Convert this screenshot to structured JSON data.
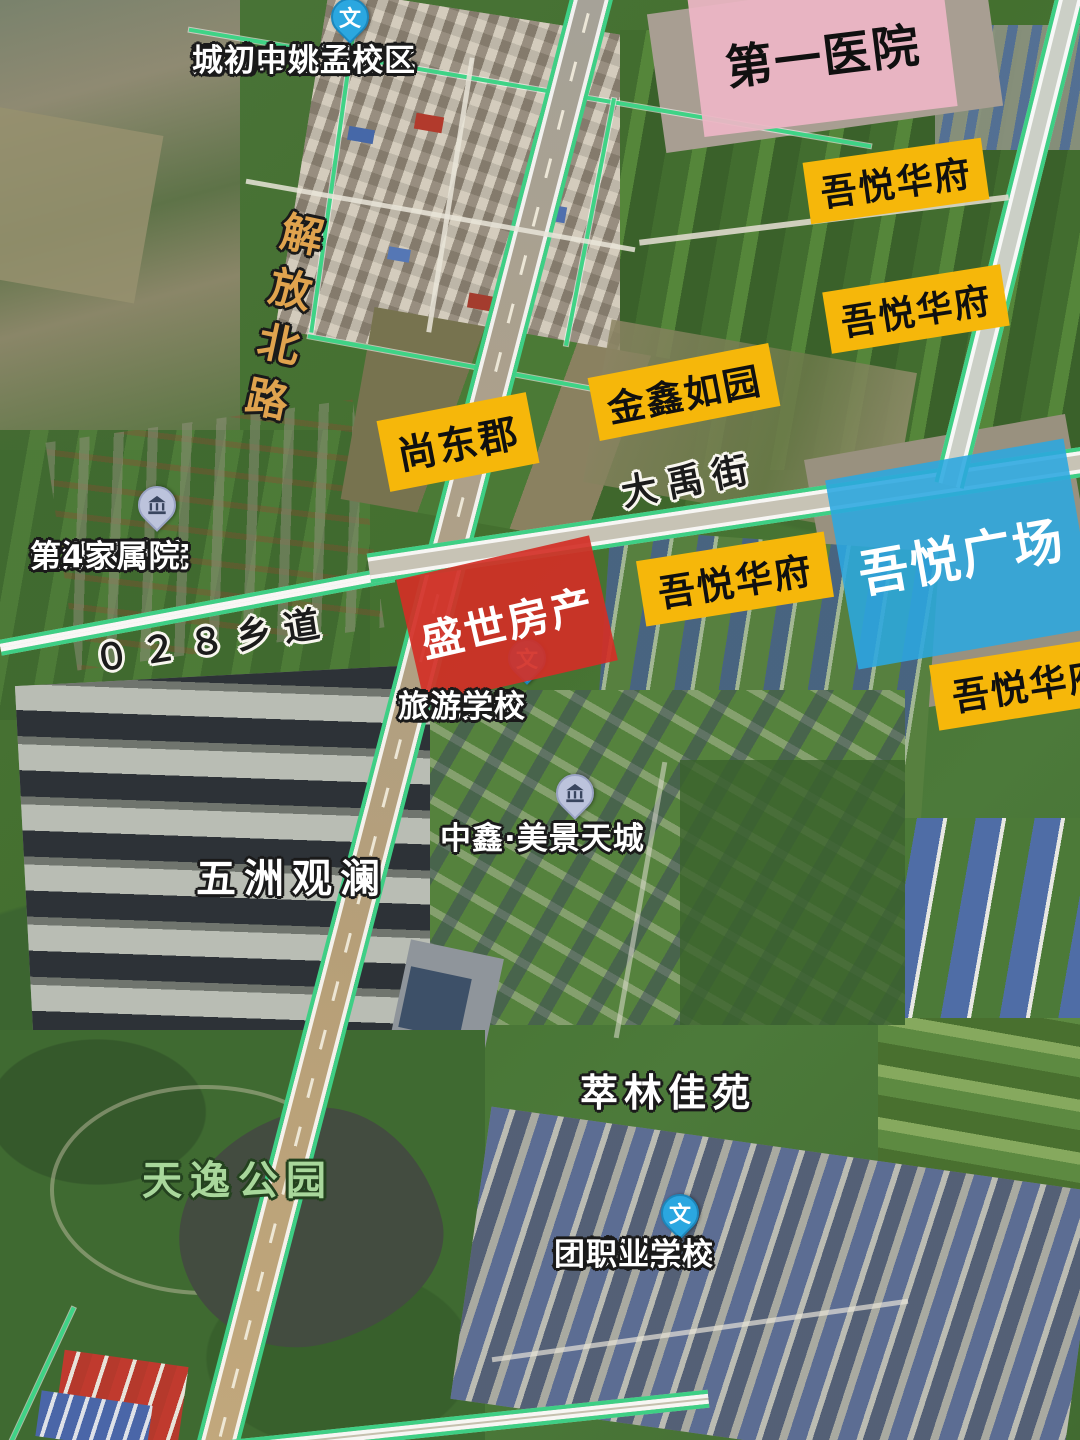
{
  "map": {
    "type": "satellite-map-screenshot",
    "colors": {
      "label_yellow": "#F6B70A",
      "label_pink": "#ECB6C5",
      "label_red": "#D32F26",
      "label_blue": "#2BA7E0",
      "road_edge_green": "#3ECF85",
      "road_name_orange": "#E0A34E",
      "park_name_green": "#A8D79B",
      "pin_blue": "#2BA7E0",
      "pin_grey": "#BCC3DC"
    },
    "poi_boxes": [
      {
        "text": "第一医院"
      },
      {
        "text": "吾悦华府"
      },
      {
        "text": "吾悦华府"
      },
      {
        "text": "金鑫如园"
      },
      {
        "text": "尚东郡"
      },
      {
        "text": "吾悦广场"
      },
      {
        "text": "吾悦华府"
      },
      {
        "text": "吾悦华府"
      },
      {
        "text": "盛世房产"
      }
    ],
    "pins": [
      {
        "glyph": "文",
        "lines": [
          "运城市盐湖区北",
          "城初中姚孟校区"
        ]
      },
      {
        "glyph": "building",
        "lines": [
          "盐湖区法院",
          "第4家属院"
        ]
      },
      {
        "glyph": "文",
        "lines": [
          "运城关圣",
          "旅游学校"
        ]
      },
      {
        "glyph": "building",
        "lines": [
          "中鑫·美景天城"
        ]
      },
      {
        "glyph": "文",
        "lines": [
          "运城制版集",
          "团职业学校"
        ]
      }
    ],
    "road_labels": [
      {
        "text": "解放北路"
      },
      {
        "text": "大禹街"
      },
      {
        "text": "０２８乡道"
      }
    ],
    "area_labels": [
      {
        "text": "五洲观澜"
      },
      {
        "text": "萃林佳苑"
      },
      {
        "text": "天逸公园"
      }
    ]
  }
}
